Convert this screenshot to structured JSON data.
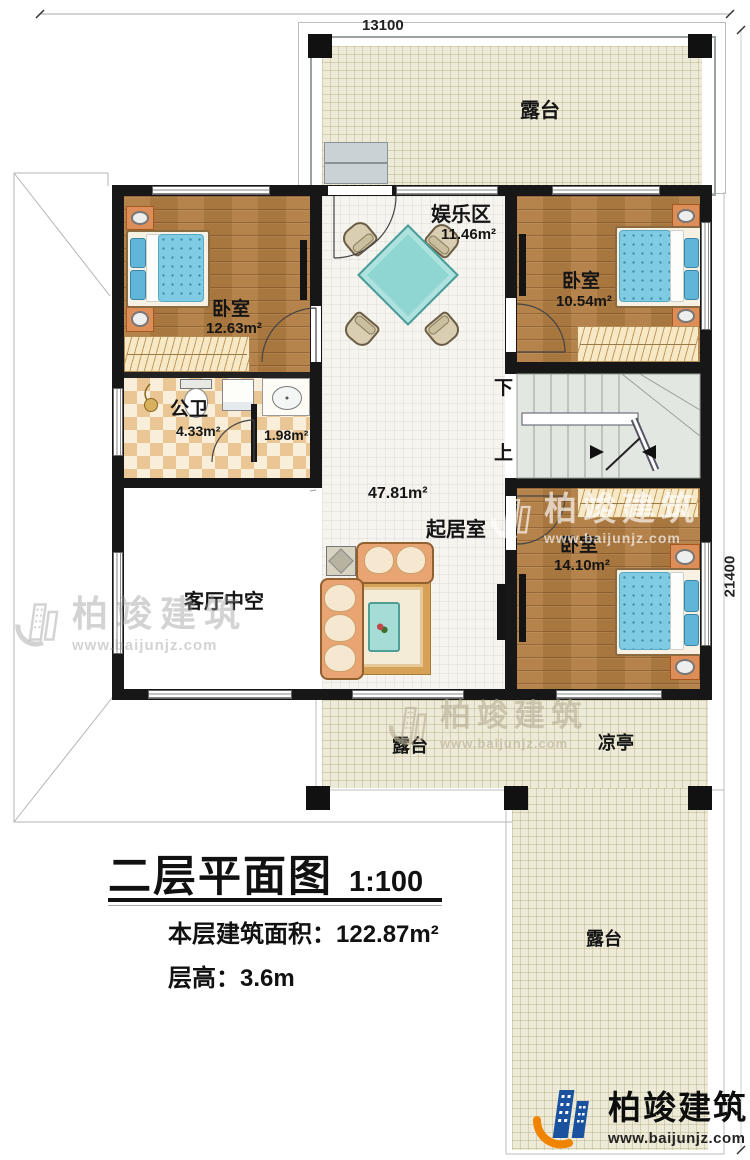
{
  "dimensions": {
    "width_label": "13100",
    "height_label": "21400"
  },
  "rooms": {
    "terrace_top": {
      "name": "露台"
    },
    "bedroom_left": {
      "name": "卧室",
      "area": "12.63m²"
    },
    "entertainment": {
      "name": "娱乐区",
      "area": "11.46m²"
    },
    "bedroom_top_right": {
      "name": "卧室",
      "area": "10.54m²"
    },
    "bathroom": {
      "name": "公卫",
      "area": "4.33m²"
    },
    "washroom": {
      "area": "1.98m²"
    },
    "living": {
      "name": "起居室",
      "area": "47.81m²"
    },
    "void": {
      "name": "客厅中空"
    },
    "bedroom_bottom_right": {
      "name": "卧室",
      "area": "14.10m²"
    },
    "terrace_bottom": {
      "name": "露台"
    },
    "pavilion": {
      "name": "凉亭"
    },
    "terrace_right": {
      "name": "露台"
    }
  },
  "stairs": {
    "down": "下",
    "up": "上"
  },
  "title_block": {
    "title": "二层平面图",
    "scale": "1:100",
    "area_line": "本层建筑面积：122.87m²",
    "height_line": "层高：3.6m"
  },
  "brand": {
    "name": "柏竣建筑",
    "url": "www.baijunjz.com"
  },
  "colors": {
    "wall": "#171717",
    "wood_floor": "#b17c42",
    "terrace_fill": "#edead7",
    "bath_tile": "#e9c694",
    "mattress_blue": "#7ecbe2",
    "table_teal": "#8fd6d2",
    "brand_blue": "#1a52a0",
    "brand_orange": "#f08300"
  }
}
